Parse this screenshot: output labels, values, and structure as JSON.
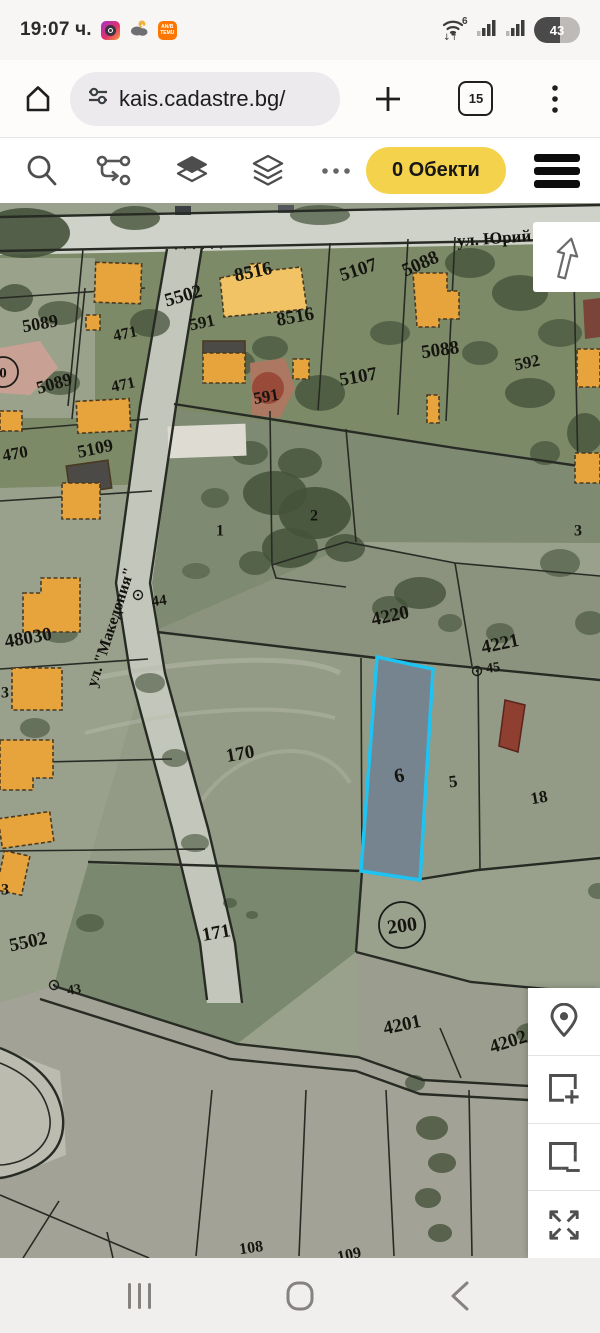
{
  "status_bar": {
    "time": "19:07 ч.",
    "battery_percent": "43",
    "wifi_generation": "6",
    "temu_line1": "AN/B",
    "temu_line2": "TEMU",
    "app_icons": [
      "instagram-icon",
      "weather-icon",
      "temu-icon"
    ]
  },
  "browser_bar": {
    "url": "kais.cadastre.bg/",
    "tab_count": "15"
  },
  "web_toolbar": {
    "objects_button_label": "0 Обекти",
    "accent_yellow": "#f5d24b"
  },
  "map": {
    "highlighted_parcel_number": "6",
    "highlight_border_color": "#1fc3f2",
    "building_color": "#e8a43c",
    "street_labels": [
      {
        "text": "ул. Юрий Га",
        "x": 505,
        "y": 34,
        "rot": -4,
        "size": 17
      },
      {
        "text": "ул. \"Македония\"",
        "x": 110,
        "y": 424,
        "rot": -72,
        "size": 16
      }
    ],
    "parcel_labels": [
      {
        "text": "5089",
        "x": 40,
        "y": 120,
        "rot": -10,
        "size": 18
      },
      {
        "text": "471",
        "x": 125,
        "y": 130,
        "rot": -12,
        "size": 16
      },
      {
        "text": "5502",
        "x": 183,
        "y": 92,
        "rot": -16,
        "size": 19
      },
      {
        "text": "8516",
        "x": 253,
        "y": 68,
        "rot": -12,
        "size": 19
      },
      {
        "text": "8516",
        "x": 295,
        "y": 113,
        "rot": -10,
        "size": 19
      },
      {
        "text": "591",
        "x": 202,
        "y": 119,
        "rot": -12,
        "size": 17
      },
      {
        "text": "5107",
        "x": 358,
        "y": 66,
        "rot": -18,
        "size": 19
      },
      {
        "text": "5088",
        "x": 420,
        "y": 60,
        "rot": -24,
        "size": 19
      },
      {
        "text": "471",
        "x": 123,
        "y": 181,
        "rot": -12,
        "size": 16
      },
      {
        "text": "5089",
        "x": 54,
        "y": 180,
        "rot": -16,
        "size": 18
      },
      {
        "text": "591",
        "x": 266,
        "y": 193,
        "rot": -10,
        "size": 17
      },
      {
        "text": "5107",
        "x": 358,
        "y": 173,
        "rot": -10,
        "size": 19
      },
      {
        "text": "5088",
        "x": 440,
        "y": 146,
        "rot": -8,
        "size": 19
      },
      {
        "text": "592",
        "x": 527,
        "y": 159,
        "rot": -12,
        "size": 17
      },
      {
        "text": "470",
        "x": 15,
        "y": 250,
        "rot": -10,
        "size": 17
      },
      {
        "text": "5109",
        "x": 95,
        "y": 245,
        "rot": -12,
        "size": 18
      },
      {
        "text": "1",
        "x": 220,
        "y": 327,
        "rot": 0,
        "size": 16
      },
      {
        "text": "2",
        "x": 314,
        "y": 312,
        "rot": 0,
        "size": 16
      },
      {
        "text": "3",
        "x": 578,
        "y": 327,
        "rot": 0,
        "size": 16
      },
      {
        "text": "4220",
        "x": 390,
        "y": 412,
        "rot": -12,
        "size": 19
      },
      {
        "text": "4221",
        "x": 500,
        "y": 440,
        "rot": -12,
        "size": 19
      },
      {
        "text": "48030",
        "x": 28,
        "y": 434,
        "rot": -10,
        "size": 19
      },
      {
        "text": "3",
        "x": 5,
        "y": 489,
        "rot": 0,
        "size": 16
      },
      {
        "text": "170",
        "x": 240,
        "y": 550,
        "rot": -10,
        "size": 19
      },
      {
        "text": "6",
        "x": 399,
        "y": 572,
        "rot": -12,
        "size": 20
      },
      {
        "text": "5",
        "x": 453,
        "y": 578,
        "rot": -8,
        "size": 17
      },
      {
        "text": "18",
        "x": 539,
        "y": 594,
        "rot": -10,
        "size": 17
      },
      {
        "text": "3",
        "x": 5,
        "y": 686,
        "rot": 0,
        "size": 16
      },
      {
        "text": "5502",
        "x": 28,
        "y": 738,
        "rot": -12,
        "size": 19
      },
      {
        "text": "171",
        "x": 216,
        "y": 729,
        "rot": -10,
        "size": 19
      },
      {
        "text": "4201",
        "x": 402,
        "y": 821,
        "rot": -12,
        "size": 19
      },
      {
        "text": "4202",
        "x": 508,
        "y": 838,
        "rot": -18,
        "size": 19
      },
      {
        "text": "108",
        "x": 251,
        "y": 1044,
        "rot": -8,
        "size": 16
      },
      {
        "text": "109",
        "x": 349,
        "y": 1051,
        "rot": -12,
        "size": 16
      }
    ],
    "point_markers": [
      {
        "text": "44",
        "cx": 138,
        "cy": 392,
        "tx": 159,
        "ty": 397,
        "size": 15
      },
      {
        "text": "43",
        "cx": 54,
        "cy": 782,
        "tx": 74,
        "ty": 786,
        "size": 14
      },
      {
        "text": "45",
        "cx": 477,
        "cy": 468,
        "tx": 493,
        "ty": 464,
        "size": 14
      }
    ],
    "circled_labels": [
      {
        "text": "200",
        "cx": 402,
        "cy": 722,
        "r": 23,
        "size": 20,
        "rot": -8
      },
      {
        "text": "0",
        "cx": 3,
        "cy": 169,
        "r": 15,
        "size": 15,
        "rot": 0
      }
    ]
  },
  "map_tools": [
    "location-pin",
    "select-add-rectangle",
    "select-subtract-rectangle",
    "expand-arrows"
  ],
  "bottom_nav": [
    "recents",
    "home",
    "back"
  ]
}
